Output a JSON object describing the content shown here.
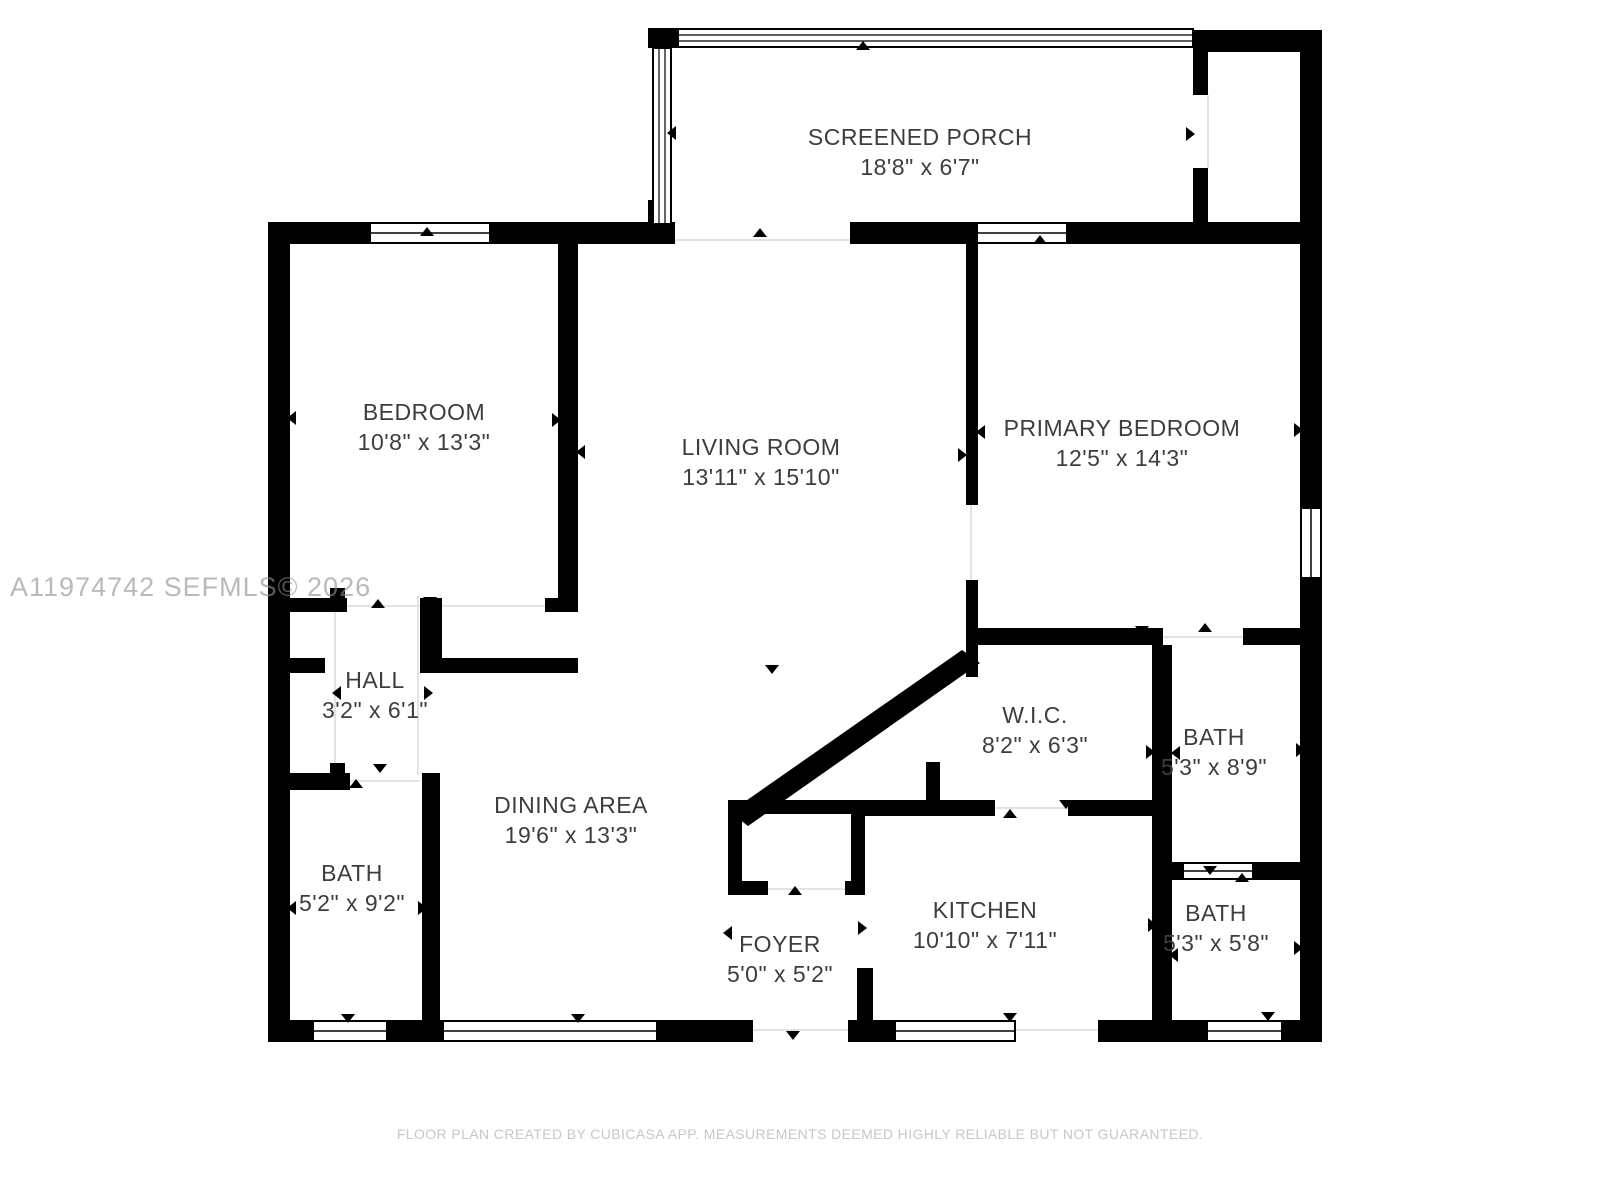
{
  "watermark": "A11974742  SEFMLS© 2026",
  "footer": "FLOOR PLAN CREATED BY CUBICASA APP. MEASUREMENTS DEEMED HIGHLY RELIABLE BUT NOT GUARANTEED.",
  "colors": {
    "wall": "#000000",
    "label_text": "#3d3d3d",
    "watermark_text": "#8f8f8f",
    "footer_text": "#c7c7c7",
    "background": "#ffffff"
  },
  "rooms": [
    {
      "id": "screened-porch",
      "name": "SCREENED PORCH",
      "dims": "18'8\" x 6'7\""
    },
    {
      "id": "bedroom",
      "name": "BEDROOM",
      "dims": "10'8\" x 13'3\""
    },
    {
      "id": "living-room",
      "name": "LIVING ROOM",
      "dims": "13'11\" x 15'10\""
    },
    {
      "id": "primary-bedroom",
      "name": "PRIMARY BEDROOM",
      "dims": "12'5\" x 14'3\""
    },
    {
      "id": "hall",
      "name": "HALL",
      "dims": "3'2\" x 6'1\""
    },
    {
      "id": "wic",
      "name": "W.I.C.",
      "dims": "8'2\" x 6'3\""
    },
    {
      "id": "bath-primary",
      "name": "BATH",
      "dims": "5'3\" x 8'9\""
    },
    {
      "id": "dining-area",
      "name": "DINING AREA",
      "dims": "19'6\" x 13'3\""
    },
    {
      "id": "bath-left",
      "name": "BATH",
      "dims": "5'2\" x 9'2\""
    },
    {
      "id": "foyer",
      "name": "FOYER",
      "dims": "5'0\" x 5'2\""
    },
    {
      "id": "kitchen",
      "name": "KITCHEN",
      "dims": "10'10\" x 7'11\""
    },
    {
      "id": "bath-small",
      "name": "BATH",
      "dims": "5'3\" x 5'8\""
    }
  ]
}
